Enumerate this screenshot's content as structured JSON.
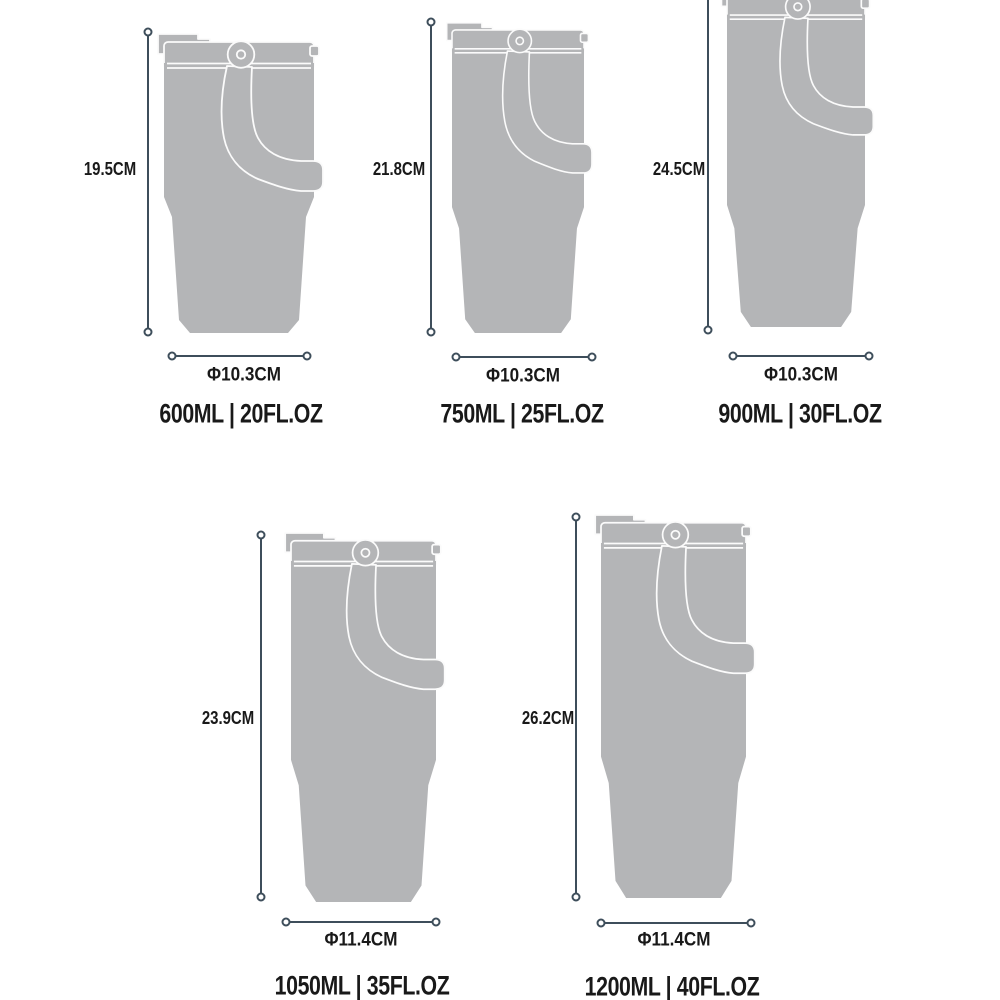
{
  "title": "Tumbler size comparison diagram",
  "colors": {
    "background": "#ffffff",
    "body_gray": "#b4b5b7",
    "outline_white": "#fbfbfb",
    "dimension": "#3e4e5b",
    "text": "#191919"
  },
  "tumblers": [
    {
      "height": "19.5CM",
      "diameter": "Φ10.3CM",
      "capacity": "600ML | 20FL.OZ"
    },
    {
      "height": "21.8CM",
      "diameter": "Φ10.3CM",
      "capacity": "750ML | 25FL.OZ"
    },
    {
      "height": "24.5CM",
      "diameter": "Φ10.3CM",
      "capacity": "900ML | 30FL.OZ"
    },
    {
      "height": "23.9CM",
      "diameter": "Φ11.4CM",
      "capacity": "1050ML | 35FL.OZ"
    },
    {
      "height": "26.2CM",
      "diameter": "Φ11.4CM",
      "capacity": "1200ML | 40FL.OZ"
    }
  ]
}
